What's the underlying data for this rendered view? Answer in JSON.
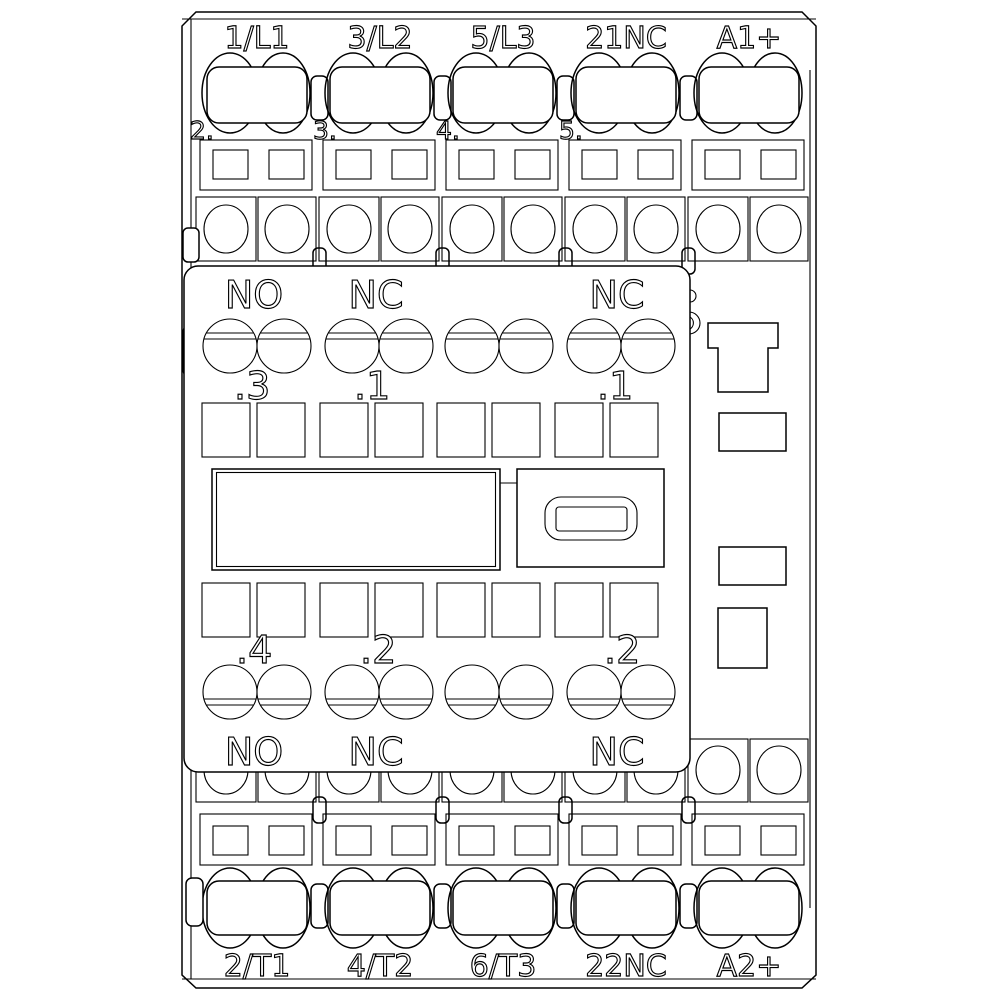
{
  "device": {
    "colors": {
      "line": "#000000",
      "background": "#ffffff"
    },
    "top_terminals": {
      "labels": [
        "1/L1",
        "3/L2",
        "5/L3",
        "21NC",
        "A1+"
      ],
      "pole_numbers": [
        "2.",
        "3.",
        "4.",
        "5."
      ]
    },
    "bottom_terminals": {
      "labels": [
        "2/T1",
        "4/T2",
        "6/T3",
        "22NC",
        "A2+"
      ]
    },
    "aux_block": {
      "top_labels": [
        "NO",
        "NC",
        "NC"
      ],
      "upper_numbers": [
        ".3",
        ".1",
        ".1"
      ],
      "lower_numbers": [
        ".4",
        ".2",
        ".2"
      ],
      "bottom_labels": [
        "NO",
        "NC",
        "NC"
      ]
    }
  }
}
